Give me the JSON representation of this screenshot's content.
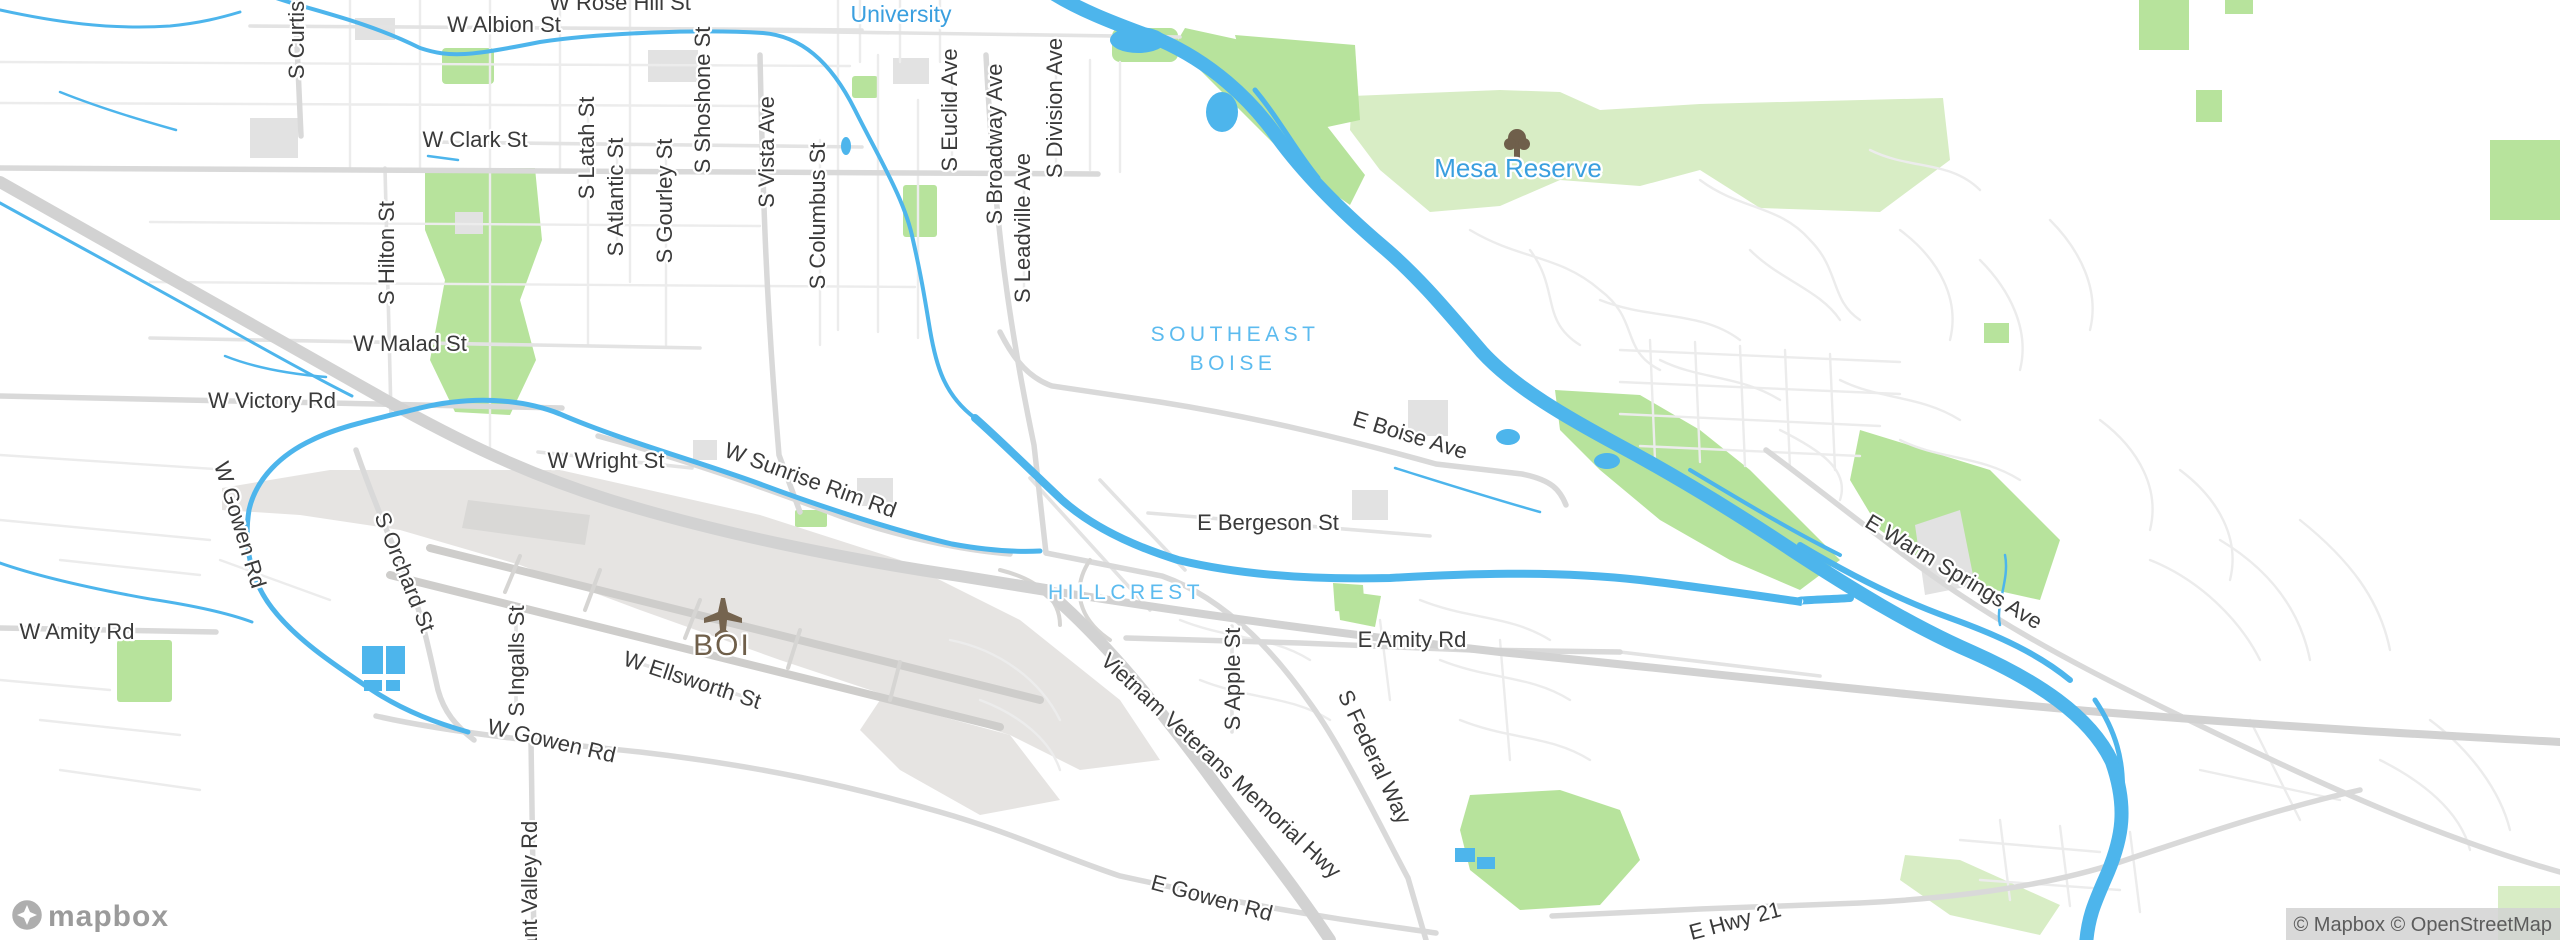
{
  "place_labels": [
    {
      "text": "University"
    },
    {
      "text": "Mesa Reserve"
    }
  ],
  "area_labels": [
    {
      "text": "SOUTHEAST"
    },
    {
      "text": "BOISE"
    },
    {
      "text": "HILLCREST"
    }
  ],
  "poi_labels": [
    {
      "text": "BOI"
    }
  ],
  "street_labels": [
    {
      "text": "W Rose Hill St"
    },
    {
      "text": "W Albion St"
    },
    {
      "text": "W Clark St"
    },
    {
      "text": "S Curtis"
    },
    {
      "text": "S Latah St"
    },
    {
      "text": "S Atlantic St"
    },
    {
      "text": "S Gourley St"
    },
    {
      "text": "S Shoshone St"
    },
    {
      "text": "S Vista Ave"
    },
    {
      "text": "S Columbus St"
    },
    {
      "text": "S Euclid Ave"
    },
    {
      "text": "S Broadway Ave"
    },
    {
      "text": "S Leadville Ave"
    },
    {
      "text": "S Division Ave"
    },
    {
      "text": "S Hilton St"
    },
    {
      "text": "W Malad St"
    },
    {
      "text": "W Victory Rd"
    },
    {
      "text": "W Wright St"
    },
    {
      "text": "W Sunrise Rim Rd"
    },
    {
      "text": "E Boise Ave"
    },
    {
      "text": "E Bergeson St"
    },
    {
      "text": "E Amity Rd"
    },
    {
      "text": "W Amity Rd"
    },
    {
      "text": "W Gowen Rd"
    },
    {
      "text": "S Orchard St"
    },
    {
      "text": "S Ingalls St"
    },
    {
      "text": "W Ellsworth St"
    },
    {
      "text": "W Gowen Rd"
    },
    {
      "text": "E Gowen Rd"
    },
    {
      "text": "S Apple St"
    },
    {
      "text": "S Federal Way"
    },
    {
      "text": "Vietnam Veterans Memorial Hwy"
    },
    {
      "text": "E Warm Springs Ave"
    },
    {
      "text": "E Hwy 21"
    },
    {
      "text": "ant Valley Rd"
    }
  ],
  "attribution": {
    "logo": "mapbox",
    "copyright": "© Mapbox © OpenStreetMap"
  },
  "colors": {
    "water": "#4db5ec",
    "park": "#b7e39c",
    "park_pale": "#d8edc5",
    "road_major": "#d9d9d9",
    "road_minor": "#ececec",
    "highway": "#d2d2d2",
    "airport_ground": "#e6e4e2",
    "street_label": "#3a3a3a",
    "place_label": "#3a9fdf",
    "area_label": "#5cbbef",
    "airport_label": "#6f5f4a"
  }
}
